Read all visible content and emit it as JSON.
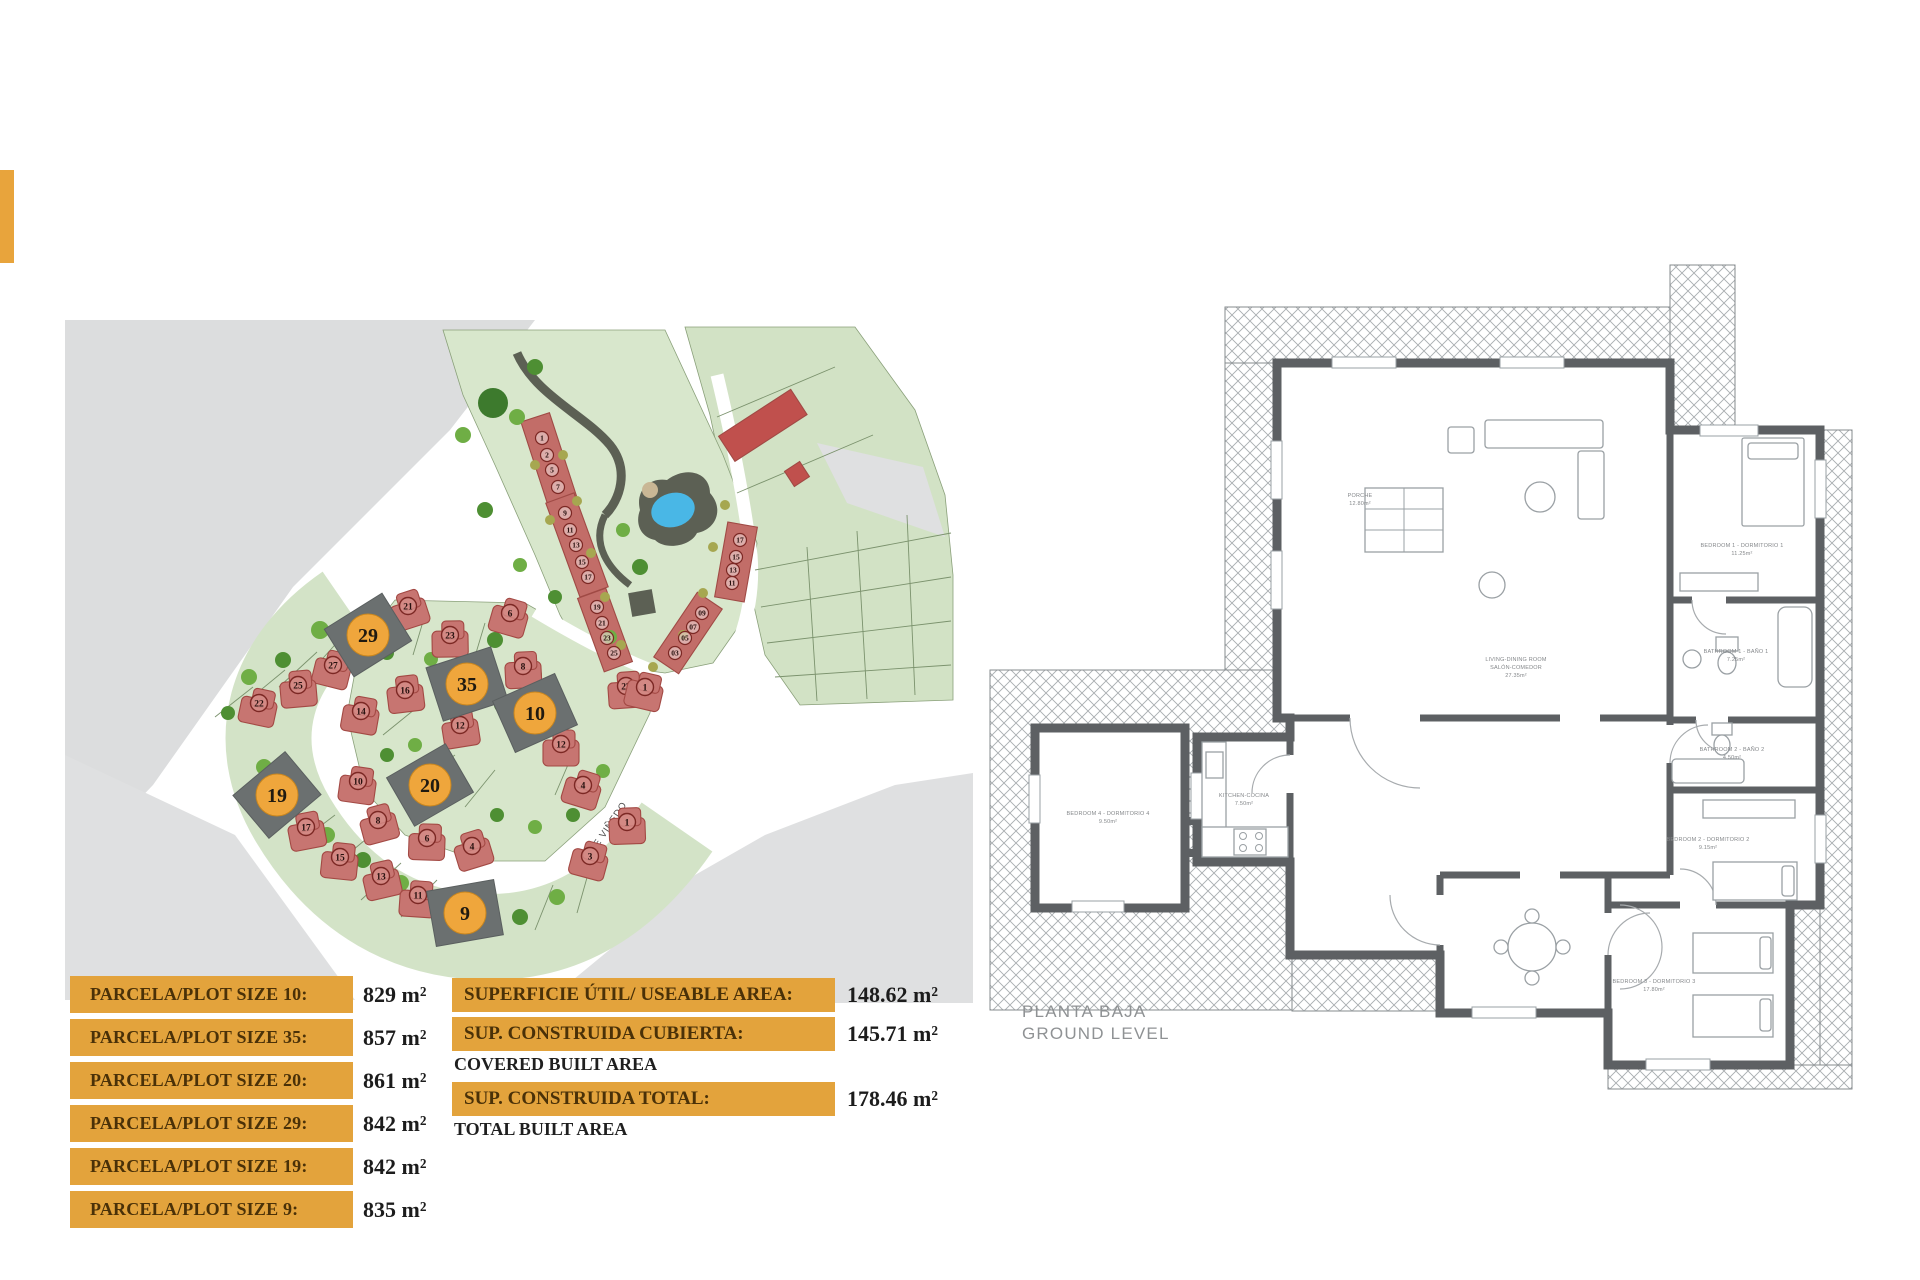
{
  "colors": {
    "accent_orange": "#e3a33c",
    "bar_text": "#4a3108",
    "value_text": "#1c1c1c",
    "map_green": "#d5e4c9",
    "map_grey": "#dcddde",
    "house_red": "#c77571",
    "plot_grey": "#6b7070",
    "plot_circle_orange": "#efa63c",
    "pool_blue": "#49b7e6",
    "wall_grey": "#5d6063"
  },
  "plot_table": {
    "rows": [
      {
        "label": "PARCELA/PLOT SIZE 10:",
        "value": "829 m²"
      },
      {
        "label": "PARCELA/PLOT SIZE 35:",
        "value": "857 m²"
      },
      {
        "label": "PARCELA/PLOT SIZE 20:",
        "value": "861 m²"
      },
      {
        "label": "PARCELA/PLOT SIZE 29:",
        "value": "842 m²"
      },
      {
        "label": "PARCELA/PLOT SIZE 19:",
        "value": "842 m²"
      },
      {
        "label": "PARCELA/PLOT SIZE 9:",
        "value": "835 m²"
      }
    ]
  },
  "area_table": {
    "rows": [
      {
        "label": "SUPERFICIE ÚTIL/ USEABLE AREA:",
        "sublabel": "",
        "value": "148.62 m²"
      },
      {
        "label": "SUP. CONSTRUIDA CUBIERTA:",
        "sublabel": "COVERED BUILT AREA",
        "value": "145.71 m²"
      },
      {
        "label": "SUP. CONSTRUIDA TOTAL:",
        "sublabel": "TOTAL BUILT AREA",
        "value": "178.46 m²"
      }
    ]
  },
  "site_plan": {
    "street_label": "CALLE VIÑEDO",
    "available_plots": [
      {
        "num": "29",
        "x": 303,
        "y": 320,
        "a": -32
      },
      {
        "num": "35",
        "x": 402,
        "y": 369,
        "a": -18
      },
      {
        "num": "10",
        "x": 470,
        "y": 398,
        "a": -24
      },
      {
        "num": "20",
        "x": 365,
        "y": 470,
        "a": -30
      },
      {
        "num": "19",
        "x": 212,
        "y": 480,
        "a": -40
      },
      {
        "num": "9",
        "x": 400,
        "y": 598,
        "a": -10
      }
    ],
    "houses": [
      {
        "n": "21",
        "x": 343,
        "y": 293
      },
      {
        "n": "23",
        "x": 385,
        "y": 322
      },
      {
        "n": "6",
        "x": 445,
        "y": 300
      },
      {
        "n": "8",
        "x": 458,
        "y": 353
      },
      {
        "n": "27",
        "x": 268,
        "y": 352
      },
      {
        "n": "25",
        "x": 233,
        "y": 372
      },
      {
        "n": "22",
        "x": 194,
        "y": 390
      },
      {
        "n": "16",
        "x": 340,
        "y": 377
      },
      {
        "n": "14",
        "x": 296,
        "y": 398
      },
      {
        "n": "12",
        "x": 395,
        "y": 412
      },
      {
        "n": "10",
        "x": 293,
        "y": 468
      },
      {
        "n": "17",
        "x": 241,
        "y": 514
      },
      {
        "n": "15",
        "x": 275,
        "y": 544
      },
      {
        "n": "13",
        "x": 316,
        "y": 563
      },
      {
        "n": "11",
        "x": 353,
        "y": 582
      },
      {
        "n": "8",
        "x": 313,
        "y": 507
      },
      {
        "n": "6",
        "x": 362,
        "y": 525
      },
      {
        "n": "4",
        "x": 407,
        "y": 533
      },
      {
        "n": "12",
        "x": 496,
        "y": 431
      },
      {
        "n": "4",
        "x": 518,
        "y": 472
      },
      {
        "n": "1",
        "x": 562,
        "y": 509
      },
      {
        "n": "3",
        "x": 525,
        "y": 543
      },
      {
        "n": "27",
        "x": 561,
        "y": 373
      },
      {
        "n": "1",
        "x": 580,
        "y": 374
      }
    ],
    "townhouse_units": [
      {
        "n": "1",
        "x": 477,
        "y": 123
      },
      {
        "n": "2",
        "x": 482,
        "y": 140
      },
      {
        "n": "5",
        "x": 487,
        "y": 155
      },
      {
        "n": "7",
        "x": 493,
        "y": 172
      },
      {
        "n": "9",
        "x": 500,
        "y": 198
      },
      {
        "n": "11",
        "x": 505,
        "y": 215
      },
      {
        "n": "13",
        "x": 511,
        "y": 230
      },
      {
        "n": "15",
        "x": 517,
        "y": 247
      },
      {
        "n": "17",
        "x": 523,
        "y": 262
      },
      {
        "n": "19",
        "x": 532,
        "y": 292
      },
      {
        "n": "21",
        "x": 537,
        "y": 308
      },
      {
        "n": "23",
        "x": 542,
        "y": 323
      },
      {
        "n": "25",
        "x": 549,
        "y": 338
      },
      {
        "n": "17",
        "x": 675,
        "y": 225
      },
      {
        "n": "15",
        "x": 671,
        "y": 242
      },
      {
        "n": "13",
        "x": 668,
        "y": 255
      },
      {
        "n": "11",
        "x": 667,
        "y": 268
      },
      {
        "n": "09",
        "x": 637,
        "y": 298
      },
      {
        "n": "07",
        "x": 628,
        "y": 312
      },
      {
        "n": "05",
        "x": 620,
        "y": 323
      },
      {
        "n": "03",
        "x": 610,
        "y": 338
      }
    ]
  },
  "floor_plan": {
    "title": "PLANTA BAJA",
    "subtitle": "GROUND LEVEL",
    "rooms": {
      "porch": {
        "l1": "PORCHE",
        "l2": "12.80m²"
      },
      "living": {
        "l1": "LIVING-DINING ROOM",
        "l2": "SALÓN-COMEDOR",
        "l3": "27.35m²"
      },
      "kitchen": {
        "l1": "KITCHEN-COCINA",
        "l2": "7.50m²"
      },
      "bed1": {
        "l1": "BEDROOM 1 - DORMITORIO 1",
        "l2": "11.25m²"
      },
      "bath1": {
        "l1": "BATHROOM 1 - BAÑO 1",
        "l2": "7.25m²"
      },
      "bath2": {
        "l1": "BATHROOM 2 - BAÑO 2",
        "l2": "4.50m²"
      },
      "bed2": {
        "l1": "BEDROOM 2 - DORMITORIO 2",
        "l2": "9.15m²"
      },
      "bed3": {
        "l1": "BEDROOM 3 - DORMITORIO 3",
        "l2": "17.80m²"
      },
      "bed4": {
        "l1": "BEDROOM 4 - DORMITORIO 4",
        "l2": "9.50m²"
      }
    }
  }
}
